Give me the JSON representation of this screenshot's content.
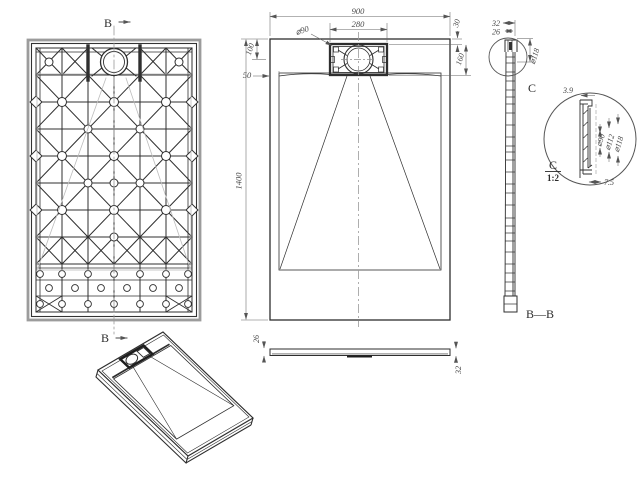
{
  "views": {
    "bottom": {
      "section_marker_top": "B",
      "section_marker_bottom": "B"
    },
    "plan": {
      "dims": {
        "width": "900",
        "drain_width": "280",
        "drain_dia": "⌀90",
        "edge_gap": "30",
        "drain_depth": "160",
        "top_offset": "100",
        "floor_inset": "50",
        "length": "1400"
      }
    },
    "side": {
      "dims": {
        "thickness_min": "26",
        "thickness_max": "32"
      }
    },
    "section": {
      "name": "B—B",
      "detail_marker": "C",
      "dims": {
        "thickness_max": "32",
        "thickness_min": "26",
        "flange_dia": "⌀118"
      }
    },
    "detail": {
      "title": "C",
      "scale": "1:2",
      "dims": {
        "wall": "3.9",
        "foot": "7.5",
        "dia_inner": "⌀90",
        "dia_mid": "⌀112",
        "dia_outer": "⌀118"
      }
    }
  }
}
